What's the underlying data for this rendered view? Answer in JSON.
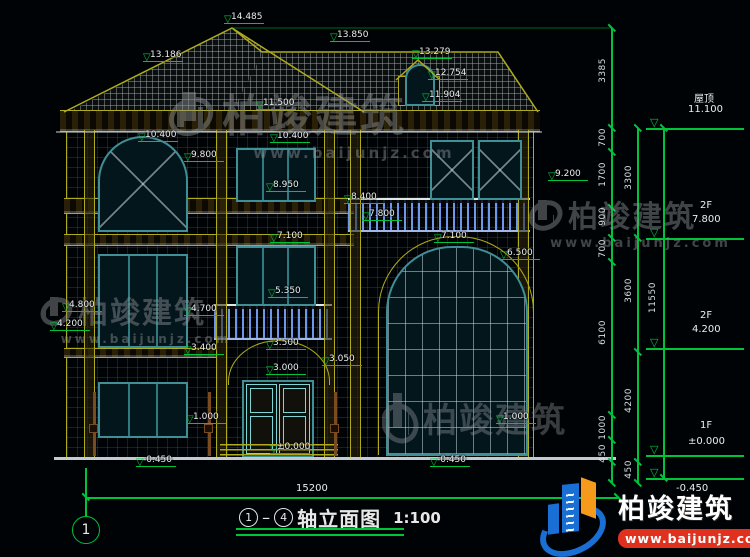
{
  "colors": {
    "accent_green": "#00c33a",
    "cad_yellow": "#b0ab1a",
    "window_teal": "#3f8f96",
    "baluster_blue": "#6f97e8",
    "logo_blue": "#1a6fd4",
    "logo_orange": "#f59a1a",
    "logo_red": "#e0301e"
  },
  "title_block": {
    "axis_start": "1",
    "axis_end": "4",
    "name": "轴立面图",
    "scale": "1:100"
  },
  "axis_bubble": {
    "number": "1"
  },
  "bottom_dim": {
    "total_width": "15200"
  },
  "levels": [
    {
      "label": "屋顶",
      "value": "11.100"
    },
    {
      "label": "2F",
      "value": "7.800"
    },
    {
      "label": "2F",
      "value": "4.200"
    },
    {
      "label": "1F",
      "value": "±0.000"
    },
    {
      "label": "",
      "value": "-0.450"
    }
  ],
  "chain_labels": [
    {
      "text": "3385",
      "x": 598,
      "y": 58
    },
    {
      "text": "700",
      "x": 598,
      "y": 128
    },
    {
      "text": "1700",
      "x": 598,
      "y": 162
    },
    {
      "text": "900",
      "x": 598,
      "y": 207
    },
    {
      "text": "700",
      "x": 598,
      "y": 239
    },
    {
      "text": "6100",
      "x": 598,
      "y": 320
    },
    {
      "text": "1000",
      "x": 598,
      "y": 415
    },
    {
      "text": "450",
      "x": 598,
      "y": 444
    },
    {
      "text": "3300",
      "x": 624,
      "y": 165
    },
    {
      "text": "3600",
      "x": 624,
      "y": 278
    },
    {
      "text": "4200",
      "x": 624,
      "y": 388
    },
    {
      "text": "450",
      "x": 624,
      "y": 460
    },
    {
      "text": "11550",
      "x": 648,
      "y": 282
    }
  ],
  "chain_ticks": [
    {
      "x": 612,
      "y": 28
    },
    {
      "x": 612,
      "y": 128
    },
    {
      "x": 612,
      "y": 152
    },
    {
      "x": 612,
      "y": 208
    },
    {
      "x": 612,
      "y": 238
    },
    {
      "x": 612,
      "y": 262
    },
    {
      "x": 612,
      "y": 415
    },
    {
      "x": 612,
      "y": 440
    },
    {
      "x": 612,
      "y": 462
    },
    {
      "x": 612,
      "y": 483
    },
    {
      "x": 638,
      "y": 128
    },
    {
      "x": 638,
      "y": 238
    },
    {
      "x": 638,
      "y": 352
    },
    {
      "x": 638,
      "y": 462
    },
    {
      "x": 638,
      "y": 483
    },
    {
      "x": 664,
      "y": 128
    },
    {
      "x": 664,
      "y": 478
    },
    {
      "x": 86,
      "y": 497
    },
    {
      "x": 618,
      "y": 497
    }
  ],
  "dim_markers": [
    {
      "value": "14.485",
      "x": 224,
      "y": 12
    },
    {
      "value": "13.850",
      "x": 330,
      "y": 30
    },
    {
      "value": "13.279",
      "x": 412,
      "y": 47
    },
    {
      "value": "12.754",
      "x": 428,
      "y": 68
    },
    {
      "value": "11.904",
      "x": 422,
      "y": 90
    },
    {
      "value": "13.186",
      "x": 143,
      "y": 50
    },
    {
      "value": "11.500",
      "x": 256,
      "y": 98
    },
    {
      "value": "10.400",
      "x": 138,
      "y": 130
    },
    {
      "value": "10.400",
      "x": 270,
      "y": 131
    },
    {
      "value": "9.800",
      "x": 184,
      "y": 150
    },
    {
      "value": "9.200",
      "x": 548,
      "y": 169
    },
    {
      "value": "8.950",
      "x": 266,
      "y": 180
    },
    {
      "value": "8.400",
      "x": 344,
      "y": 192
    },
    {
      "value": "7.800",
      "x": 362,
      "y": 209
    },
    {
      "value": "7.100",
      "x": 270,
      "y": 231
    },
    {
      "value": "7.100",
      "x": 434,
      "y": 231
    },
    {
      "value": "6.500",
      "x": 500,
      "y": 248
    },
    {
      "value": "5.350",
      "x": 268,
      "y": 286
    },
    {
      "value": "4.800",
      "x": 62,
      "y": 300
    },
    {
      "value": "4.200",
      "x": 50,
      "y": 319
    },
    {
      "value": "4.700",
      "x": 184,
      "y": 304
    },
    {
      "value": "3.400",
      "x": 184,
      "y": 343
    },
    {
      "value": "3.500",
      "x": 266,
      "y": 338
    },
    {
      "value": "3.050",
      "x": 322,
      "y": 354
    },
    {
      "value": "3.000",
      "x": 266,
      "y": 363
    },
    {
      "value": "1.000",
      "x": 186,
      "y": 412
    },
    {
      "value": "1.000",
      "x": 496,
      "y": 412
    },
    {
      "value": "±0.000",
      "x": 270,
      "y": 442
    },
    {
      "value": "-0.450",
      "x": 136,
      "y": 455
    },
    {
      "value": "-0.450",
      "x": 430,
      "y": 455
    }
  ],
  "watermark": {
    "brand": "柏竣建筑",
    "url": "www.baijunjz.com"
  },
  "footer_logo": {
    "brand": "柏竣建筑",
    "url": "www.baijunjz.com"
  }
}
